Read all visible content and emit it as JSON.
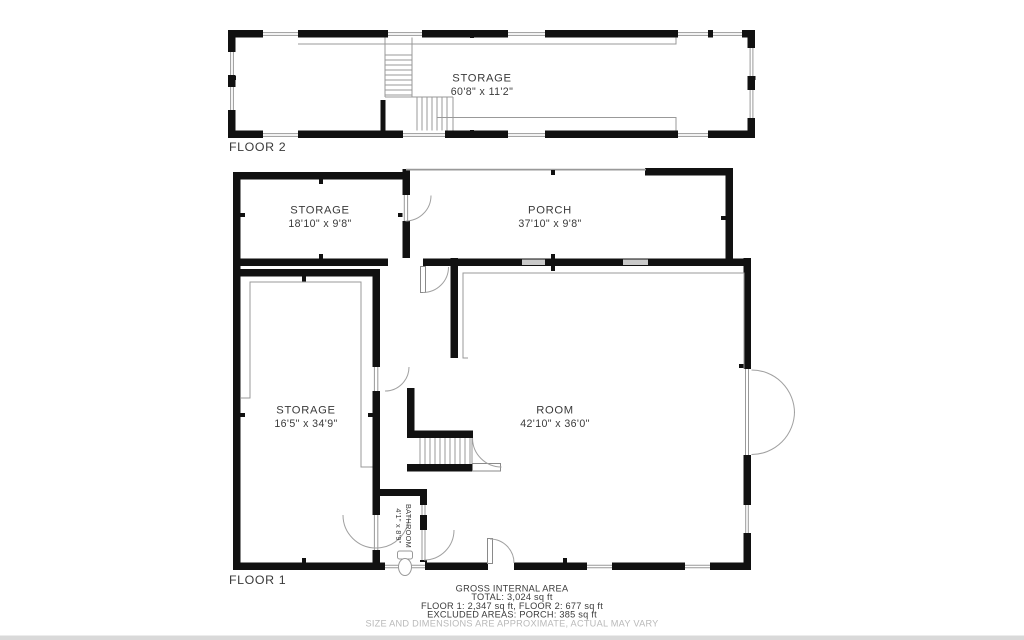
{
  "colors": {
    "wall": "#111111",
    "thin_line": "#999999",
    "window_gray": "#c9c9c9",
    "label_text": "#3a3a3a",
    "muted_text": "#b9b9b9",
    "background": "#ffffff"
  },
  "floor2": {
    "label": "FLOOR 2",
    "room": {
      "name": "STORAGE",
      "dims": "60'8\" x 11'2\""
    }
  },
  "floor1": {
    "label": "FLOOR 1",
    "storage_top": {
      "name": "STORAGE",
      "dims": "18'10\" x 9'8\""
    },
    "porch": {
      "name": "PORCH",
      "dims": "37'10\" x 9'8\""
    },
    "storage_main": {
      "name": "STORAGE",
      "dims": "16'5\" x 34'9\""
    },
    "room": {
      "name": "ROOM",
      "dims": "42'10\" x 36'0\""
    },
    "bathroom": {
      "name": "BATHROOM",
      "dims": "4'1\" x 8'9\""
    }
  },
  "footer": {
    "title": "GROSS INTERNAL AREA",
    "total": "TOTAL: 3,024 sq ft",
    "floors": "FLOOR 1: 2,347 sq ft, FLOOR 2: 677 sq ft",
    "excluded": "EXCLUDED AREAS: PORCH: 385 sq ft",
    "disclaimer": "SIZE AND DIMENSIONS ARE APPROXIMATE, ACTUAL MAY VARY"
  }
}
